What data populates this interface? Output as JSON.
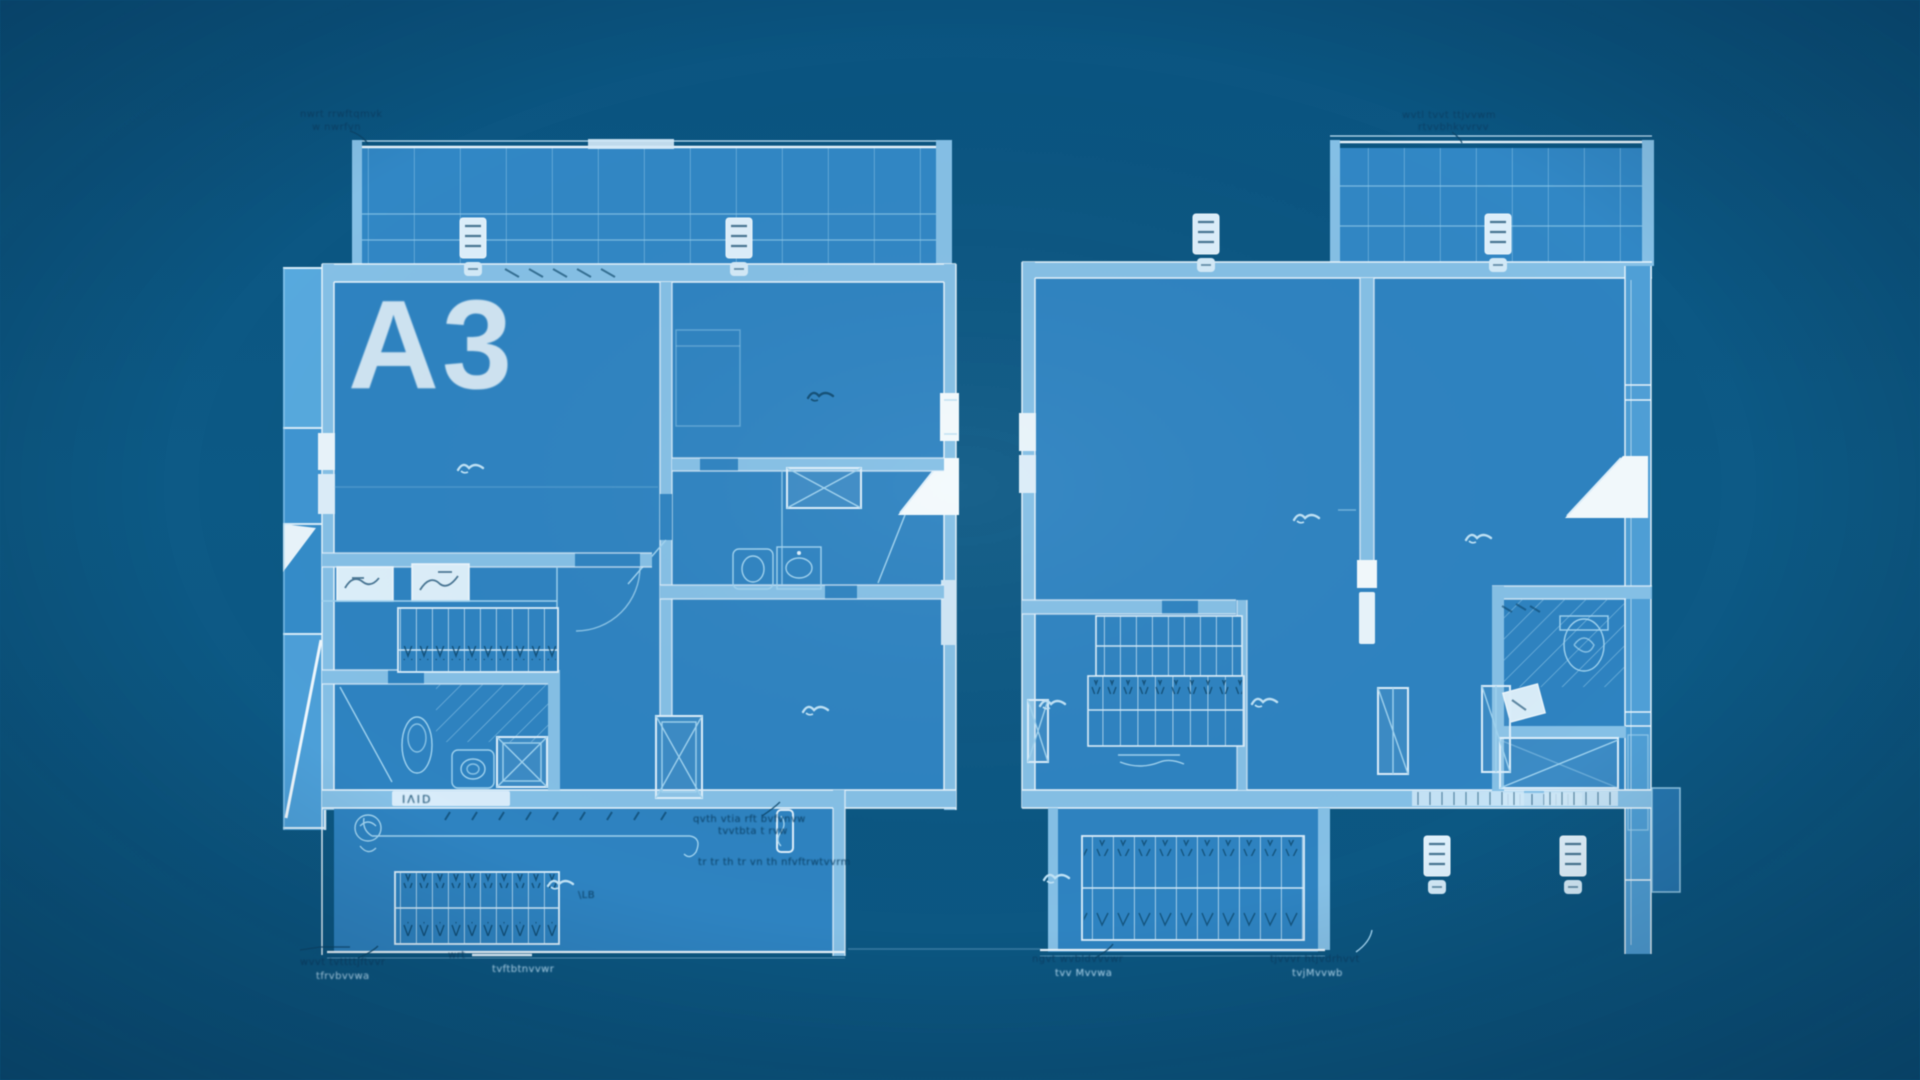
{
  "scene": {
    "type": "architectural blueprint, two apartment floor plans, monochrome blue"
  },
  "labels": {
    "unit": "A3",
    "left_top_note_1": "nwrt rrwftqmvk",
    "left_top_note_2": "w nwrfvn",
    "left_wall_plate": "ΙΛΙD",
    "left_center_note_1": "qvth vtia rft bvfvnvw",
    "left_center_note_2": "tvvtbta t rvw",
    "left_center_note_3": "tr tr th tr vn th nfvftrwtvvrm",
    "left_stair_tag": "\\LB",
    "left_bottom_note_1": "wvvt tvttttjftvvr",
    "left_bottom_note_2": "tfrvbvvwa",
    "left_bracket_tag": "wrt",
    "left_bracket_note": "tvftbtnvvwr",
    "right_top_note_1": "wvtl tvvt ttjvvwm",
    "right_top_note_2": "rtvvbhkvvrvv",
    "right_bottom_left_note_1": "ngvt wvbldvvvwr",
    "right_bottom_left_note_2": "tvv Mvvwa",
    "right_bottom_right_note_1": "tjvvvr htjvdrhvvt",
    "right_bottom_right_note_2": "tvjMvvwb"
  },
  "colors": {
    "background": "#0c5580",
    "plan_fill": "#2e83c1",
    "wall_fill": "#85c0e6",
    "line_light": "#9fd2ef",
    "line_bright": "#e8f4fc",
    "white": "#f3fafd",
    "annotation_dark": "#0a4066",
    "annotation_light": "#b5dcf3",
    "fragment_fill": "#3a90cd"
  }
}
